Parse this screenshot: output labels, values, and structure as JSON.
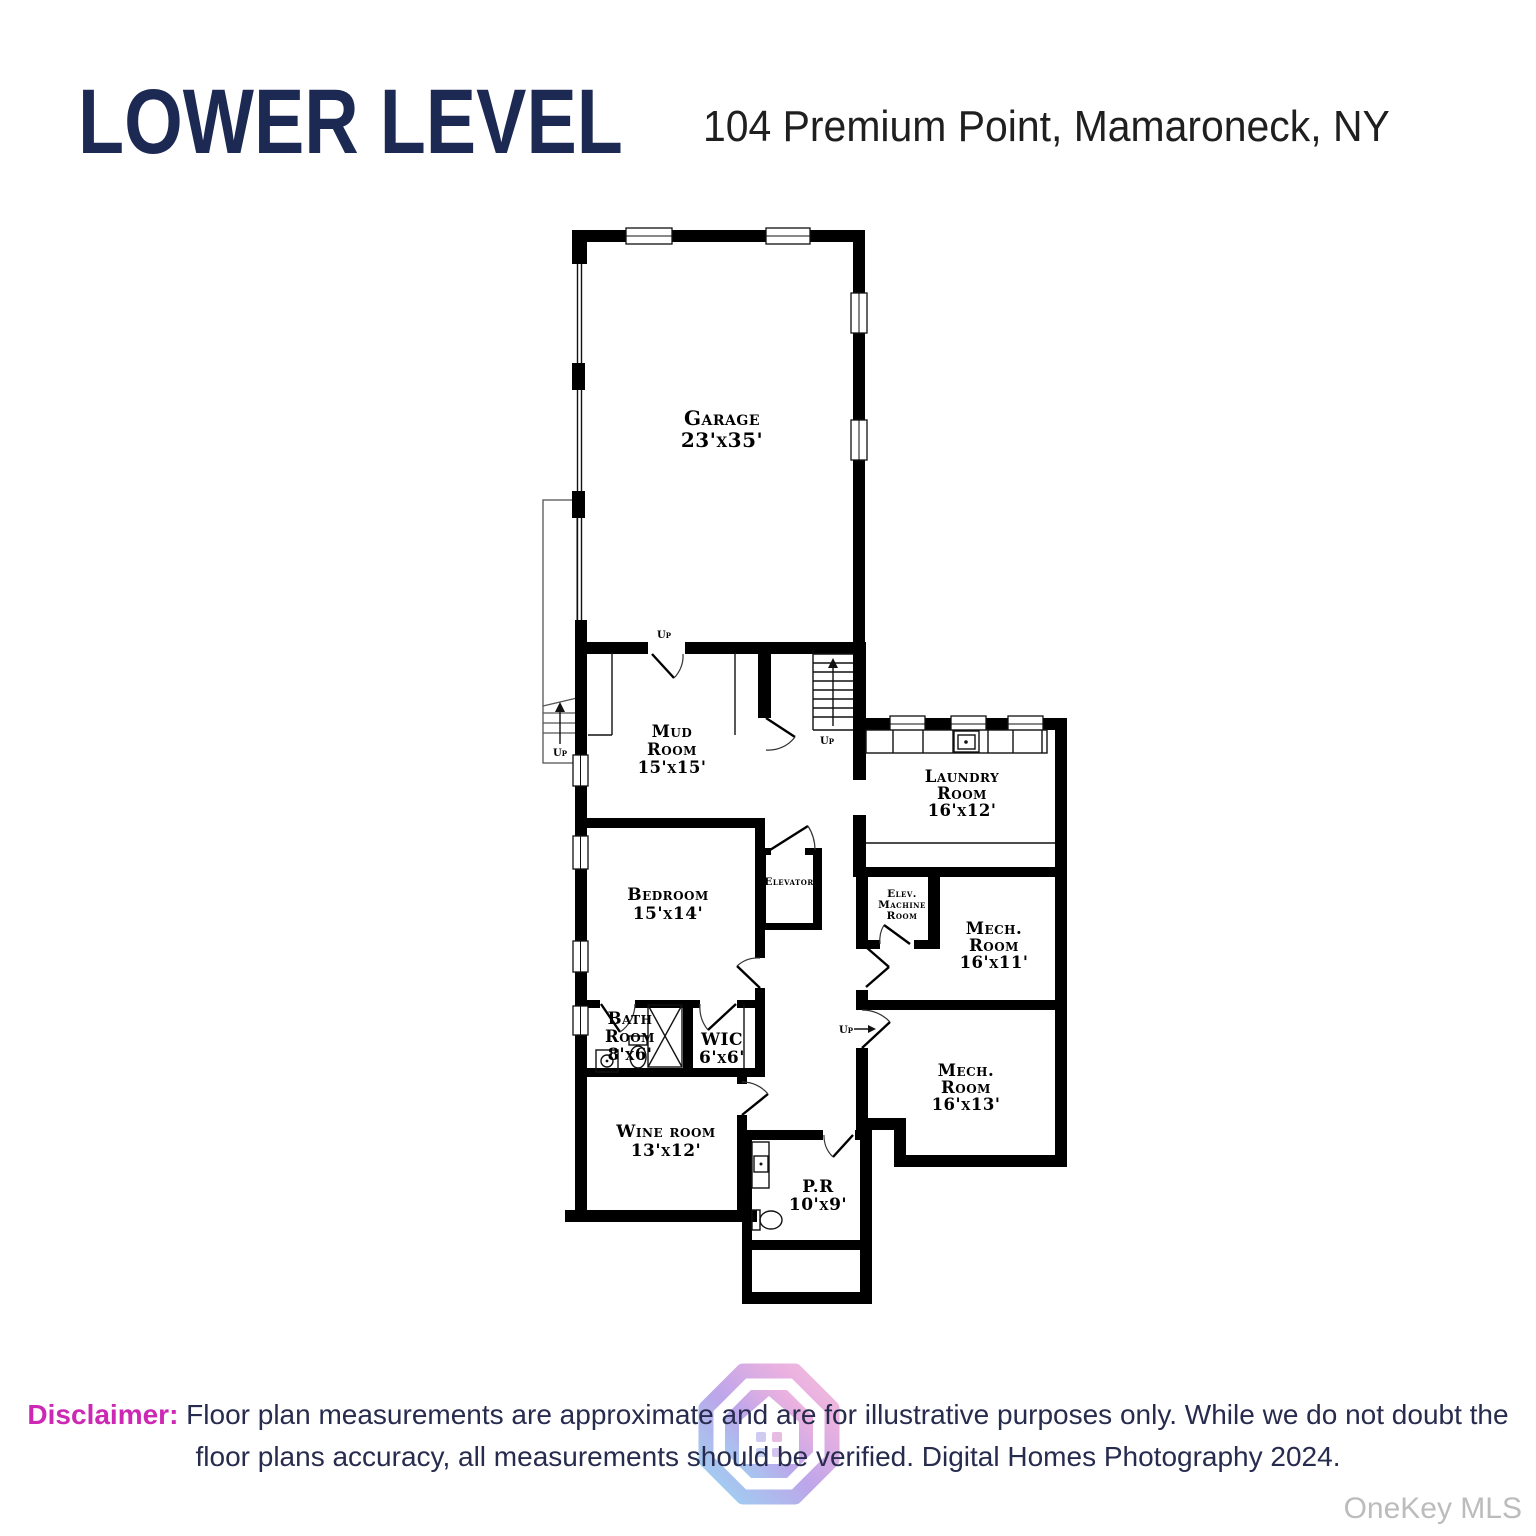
{
  "header": {
    "title": "LOWER LEVEL",
    "address": "104 Premium Point, Mamaroneck, NY"
  },
  "floorplan": {
    "rooms": {
      "garage": {
        "l1": "Garage",
        "l2": "23'x35'"
      },
      "mud": {
        "l1": "Mud",
        "l2": "Room",
        "l3": "15'x15'"
      },
      "laundry": {
        "l1": "Laundry",
        "l2": "Room",
        "l3": "16'x12'"
      },
      "bedroom": {
        "l1": "Bedroom",
        "l2": "15'x14'"
      },
      "elevator": {
        "l1": "Elevator"
      },
      "elev_machine": {
        "l1": "Elev.",
        "l2": "Machine",
        "l3": "Room"
      },
      "mech11": {
        "l1": "Mech.",
        "l2": "Room",
        "l3": "16'x11'"
      },
      "bath": {
        "l1": "Bath",
        "l2": "Room",
        "l3": "8'x6'"
      },
      "wic": {
        "l1": "WIC",
        "l2": "6'x6'"
      },
      "wine": {
        "l1": "Wine room",
        "l2": "13'x12'"
      },
      "mech13": {
        "l1": "Mech.",
        "l2": "Room",
        "l3": "16'x13'"
      },
      "pr": {
        "l1": "P.R",
        "l2": "10'x9'"
      }
    },
    "annotations": {
      "up_garage": "Up",
      "up_stairs": "Up",
      "up_left": "Up",
      "up_right": "Up"
    }
  },
  "footer": {
    "disclaimer_label": "Disclaimer:",
    "disclaimer_line1": "Floor plan measurements are approximate and are for illustrative purposes only. While we do not doubt the",
    "disclaimer_line2": "floor plans accuracy, all measurements should be verified. Digital Homes Photography 2024.",
    "brand": "OneKey MLS"
  },
  "colors": {
    "title_navy": "#1c2a53",
    "text_navy": "#272b4d",
    "accent_pink": "#cd28b4",
    "brand_gray": "#bcbcbc",
    "plan_black": "#000000"
  }
}
